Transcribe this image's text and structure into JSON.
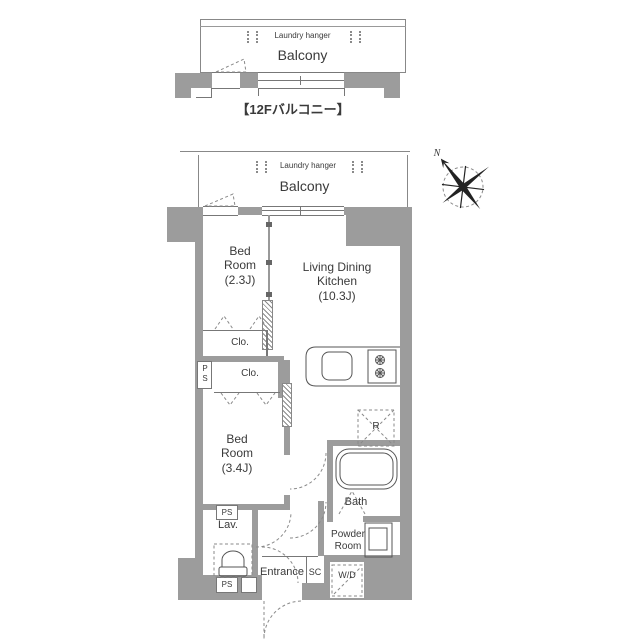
{
  "caption": "【12Fバルコニー】",
  "compass": {
    "north_label": "N"
  },
  "upper_balcony": {
    "laundry_hanger": "Laundry hanger",
    "balcony": "Balcony"
  },
  "plan": {
    "balcony": {
      "laundry_hanger": "Laundry hanger",
      "balcony": "Balcony"
    },
    "bedroom1": {
      "l1": "Bed",
      "l2": "Room",
      "size": "(2.3J)"
    },
    "ldk": {
      "l1": "Living Dining",
      "l2": "Kitchen",
      "size": "(10.3J)"
    },
    "bedroom2": {
      "l1": "Bed",
      "l2": "Room",
      "size": "(3.4J)"
    },
    "closet1": "Clo.",
    "closet2": "Clo.",
    "ps_vertical": "PS",
    "ps_mid": "PS",
    "ps_bottom": "PS",
    "lavatory": "Lav.",
    "bath": "Bath",
    "powder": {
      "l1": "Powder",
      "l2": "Room"
    },
    "entrance": "Entrance",
    "shoe_closet": "SC",
    "washer_dryer": "W/D",
    "refrigerator": "R"
  },
  "colors": {
    "wall": "#9c9c9c",
    "line": "#777777",
    "dash": "#8a8a8a",
    "text": "#3a3a3a"
  }
}
